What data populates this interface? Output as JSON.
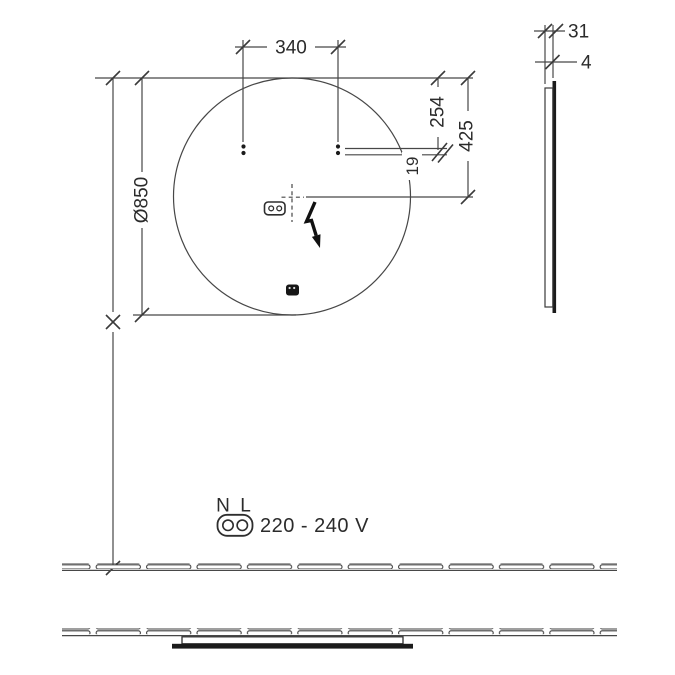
{
  "front_view": {
    "diameter_label": "Ø850",
    "hole_spacing_label": "340",
    "hole_top_offset_label": "254",
    "cable_top_offset_label": "425",
    "bracket_gap_label": "19"
  },
  "side_view": {
    "depth_label": "31",
    "glass_thickness_label": "4"
  },
  "power_legend": {
    "neutral_label": "N",
    "line_label": "L",
    "voltage_label": "220 - 240 V"
  },
  "colors": {
    "line": "#474747",
    "text": "#2b2b2b",
    "dark_fill": "#1b1b1b",
    "background": "#ffffff"
  }
}
